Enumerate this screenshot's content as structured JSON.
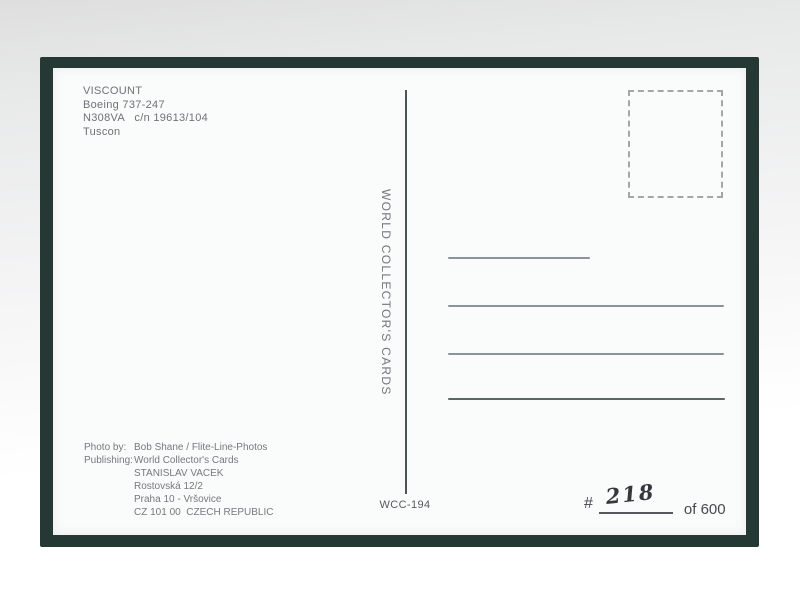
{
  "card": {
    "aircraft": {
      "name": "VISCOUNT",
      "type": "Boeing 737-247",
      "registration": "N308VA   c/n 19613/104",
      "location": "Tuscon"
    },
    "brand_vertical_text": "WORLD COLLECTOR'S CARDS",
    "credits": {
      "photo_label": "Photo by:",
      "photo_value": "Bob Shane / Flite-Line-Photos",
      "publishing_label": "Publishing:",
      "publishing_lines": [
        "World Collector's Cards",
        "STANISLAV VACEK",
        "Rostovská 12/2",
        "Praha 10 - Vršovice",
        "CZ 101 00  CZECH REPUBLIC"
      ]
    },
    "card_number": "WCC-194",
    "edition": {
      "hash_symbol": "#",
      "handwritten_number": "218",
      "of_label": "of 600"
    },
    "colors": {
      "border": "#253834",
      "printed_ink": "#6d7377",
      "address_line": "#8d9295",
      "dark_ink": "#46494d",
      "handwriting_ink": "#37383d"
    }
  }
}
